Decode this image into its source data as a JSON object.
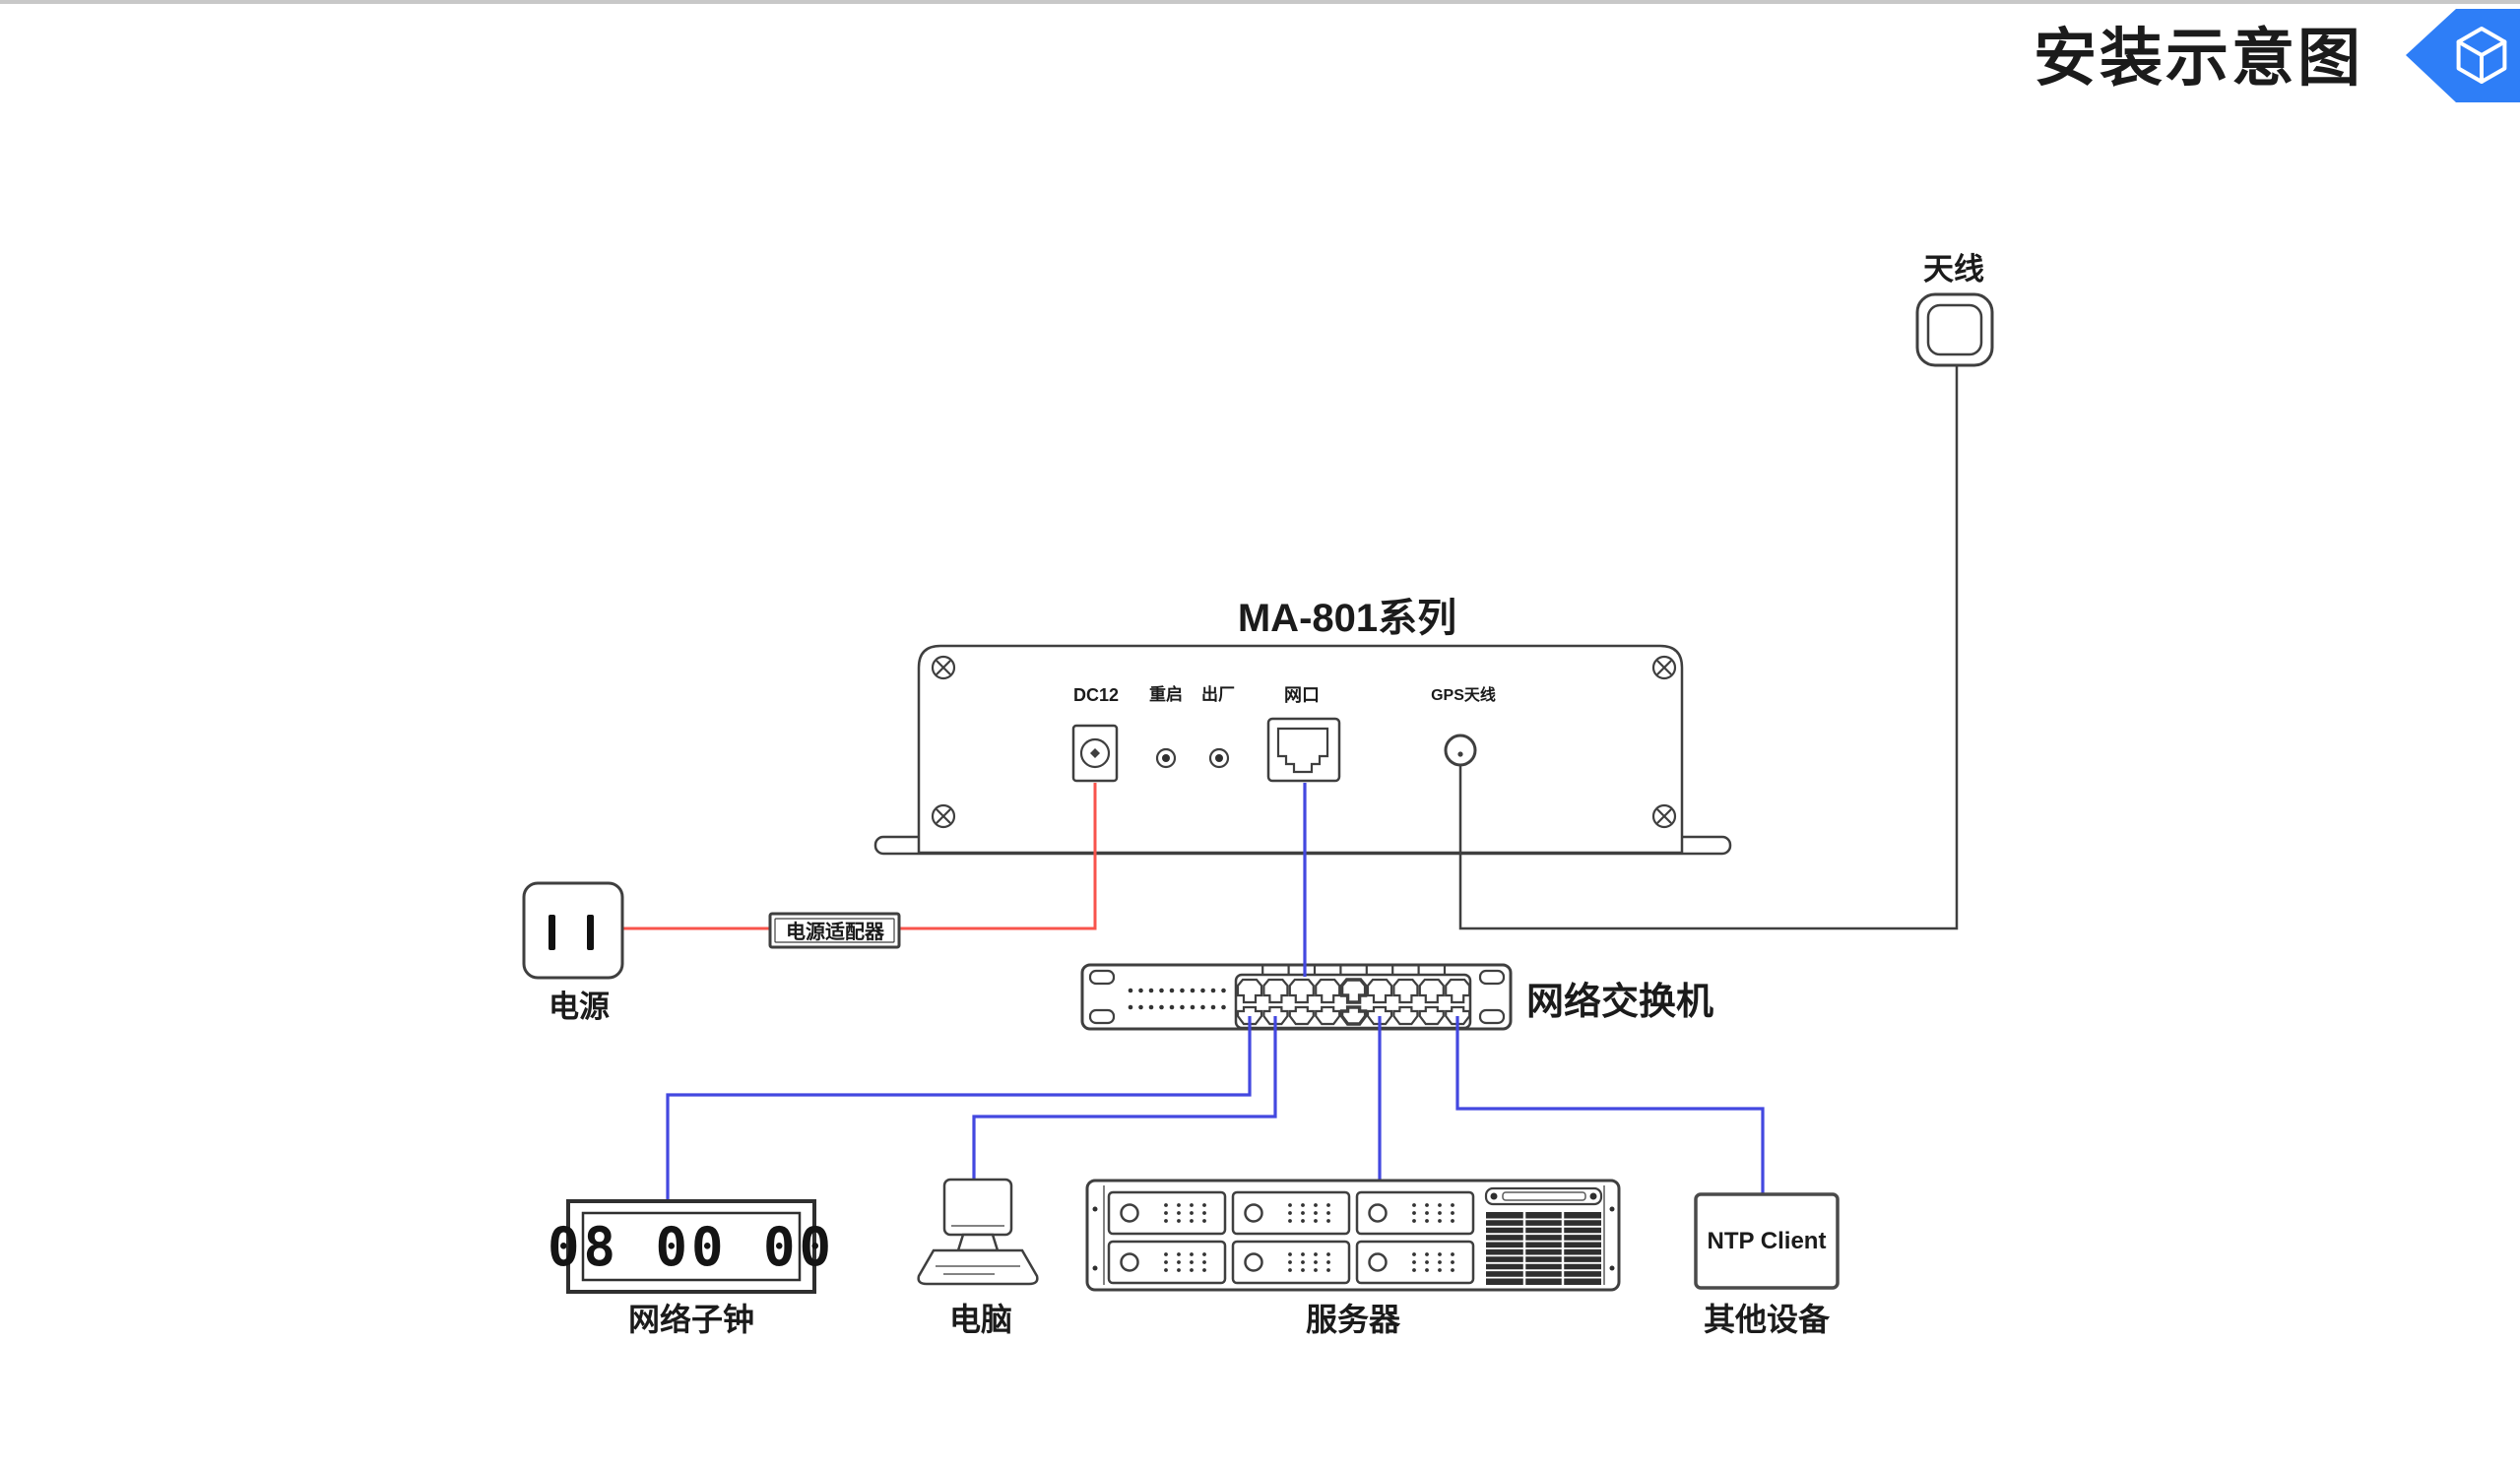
{
  "page": {
    "title": "安装示意图"
  },
  "badge": {
    "icon": "cube-3d-icon",
    "color": "#2e7ef7"
  },
  "antenna": {
    "label": "天线"
  },
  "ma801": {
    "title": "MA-801系列",
    "dc_label": "DC12",
    "reset_label": "重启",
    "factory_label": "出厂",
    "lan_label": "网口",
    "gps_label": "GPS天线"
  },
  "power": {
    "label": "电源",
    "adapter_label": "电源适配器"
  },
  "switch": {
    "label": "网络交换机"
  },
  "clock": {
    "display": "08 00 00",
    "label": "网络子钟"
  },
  "computer": {
    "label": "电脑"
  },
  "server": {
    "label": "服务器"
  },
  "other": {
    "box_label": "NTP Client",
    "label": "其他设备"
  },
  "colors": {
    "wire_red": "#f8544c",
    "wire_blue": "#4348e0",
    "wire_black": "#3f3f3f",
    "badge_blue": "#2e7ef7",
    "top_bar": "#c8c8c8"
  }
}
